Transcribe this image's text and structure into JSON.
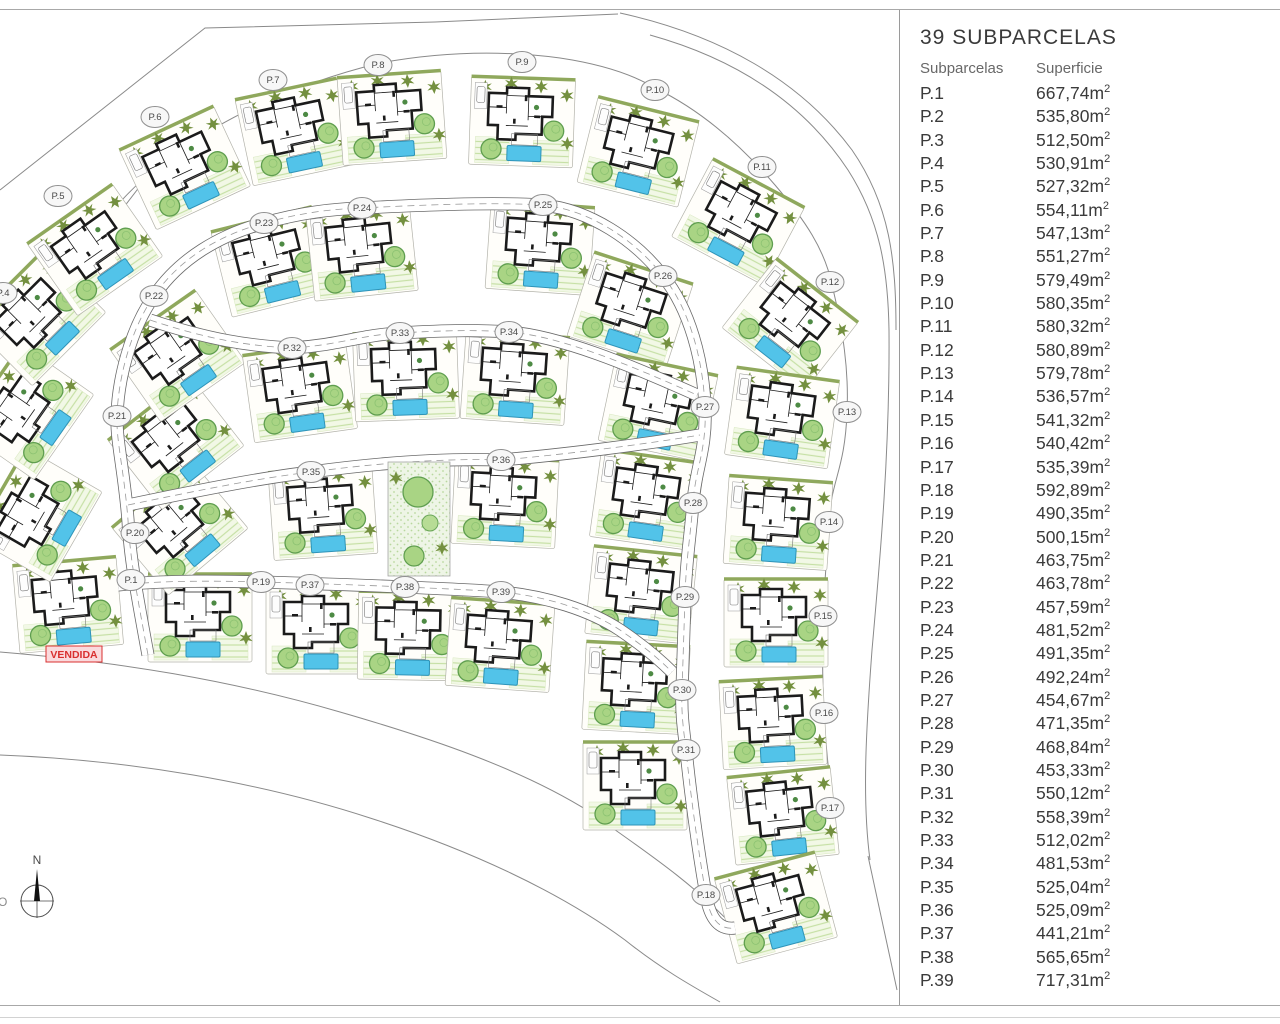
{
  "panel": {
    "title": "39 SUBPARCELAS",
    "col_subparcel": "Subparcelas",
    "col_area": "Superficie",
    "unit": "m",
    "parcels": [
      {
        "id": "P.1",
        "area": "667,74"
      },
      {
        "id": "P.2",
        "area": "535,80"
      },
      {
        "id": "P.3",
        "area": "512,50"
      },
      {
        "id": "P.4",
        "area": "530,91"
      },
      {
        "id": "P.5",
        "area": "527,32"
      },
      {
        "id": "P.6",
        "area": "554,11"
      },
      {
        "id": "P.7",
        "area": "547,13"
      },
      {
        "id": "P.8",
        "area": "551,27"
      },
      {
        "id": "P.9",
        "area": "579,49"
      },
      {
        "id": "P.10",
        "area": "580,35"
      },
      {
        "id": "P.11",
        "area": "580,32"
      },
      {
        "id": "P.12",
        "area": "580,89"
      },
      {
        "id": "P.13",
        "area": "579,78"
      },
      {
        "id": "P.14",
        "area": "536,57"
      },
      {
        "id": "P.15",
        "area": "541,32"
      },
      {
        "id": "P.16",
        "area": "540,42"
      },
      {
        "id": "P.17",
        "area": "535,39"
      },
      {
        "id": "P.18",
        "area": "592,89"
      },
      {
        "id": "P.19",
        "area": "490,35"
      },
      {
        "id": "P.20",
        "area": "500,15"
      },
      {
        "id": "P.21",
        "area": "463,75"
      },
      {
        "id": "P.22",
        "area": "463,78"
      },
      {
        "id": "P.23",
        "area": "457,59"
      },
      {
        "id": "P.24",
        "area": "481,52"
      },
      {
        "id": "P.25",
        "area": "491,35"
      },
      {
        "id": "P.26",
        "area": "492,24"
      },
      {
        "id": "P.27",
        "area": "454,67"
      },
      {
        "id": "P.28",
        "area": "471,35"
      },
      {
        "id": "P.29",
        "area": "468,84"
      },
      {
        "id": "P.30",
        "area": "453,33"
      },
      {
        "id": "P.31",
        "area": "550,12"
      },
      {
        "id": "P.32",
        "area": "558,39"
      },
      {
        "id": "P.33",
        "area": "512,02"
      },
      {
        "id": "P.34",
        "area": "481,53"
      },
      {
        "id": "P.35",
        "area": "525,04"
      },
      {
        "id": "P.36",
        "area": "525,09"
      },
      {
        "id": "P.37",
        "area": "441,21"
      },
      {
        "id": "P.38",
        "area": "565,65"
      },
      {
        "id": "P.39",
        "area": "717,31"
      }
    ]
  },
  "map": {
    "sold_label": "VENDIDA",
    "compass": {
      "north_label": "N",
      "west_label": "O"
    },
    "colors": {
      "pool": "#52c3e9",
      "pool_edge": "#2e93b8",
      "tree_fill": "#a9d484",
      "tree_edge": "#5f9e4f",
      "bush": "#74903f",
      "lawn_line": "#c6e0a5",
      "wall": "#1b1b1b",
      "road_edge": "#6a6a6a",
      "sold_red": "#d93030"
    },
    "plots": [
      {
        "label": "P.1",
        "marker": [
          131,
          580
        ],
        "house": [
          68,
          605
        ],
        "rot": -5,
        "sold": true
      },
      {
        "label": "P.2",
        "marker": null,
        "house": [
          38,
          515
        ],
        "rot": -60
      },
      {
        "label": "P.3",
        "marker": null,
        "house": [
          28,
          412
        ],
        "rot": -55
      },
      {
        "label": "P.4",
        "marker": [
          3,
          293
        ],
        "house": [
          38,
          318
        ],
        "rot": -45
      },
      {
        "label": "P.5",
        "marker": [
          58,
          196
        ],
        "house": [
          95,
          250
        ],
        "rot": -35
      },
      {
        "label": "P.6",
        "marker": [
          155,
          117
        ],
        "house": [
          185,
          168
        ],
        "rot": -25
      },
      {
        "label": "P.7",
        "marker": [
          273,
          80
        ],
        "house": [
          295,
          132
        ],
        "rot": -12
      },
      {
        "label": "P.8",
        "marker": [
          378,
          65
        ],
        "house": [
          392,
          118
        ],
        "rot": -4
      },
      {
        "label": "P.9",
        "marker": [
          522,
          62
        ],
        "house": [
          522,
          122
        ],
        "rot": 2
      },
      {
        "label": "P.10",
        "marker": [
          655,
          90
        ],
        "house": [
          638,
          152
        ],
        "rot": 14
      },
      {
        "label": "P.11",
        "marker": [
          762,
          167
        ],
        "house": [
          738,
          222
        ],
        "rot": 28
      },
      {
        "label": "P.12",
        "marker": [
          830,
          282
        ],
        "house": [
          790,
          325
        ],
        "rot": 38
      },
      {
        "label": "P.13",
        "marker": [
          847,
          412
        ],
        "house": [
          782,
          418
        ],
        "rot": 8
      },
      {
        "label": "P.14",
        "marker": [
          829,
          522
        ],
        "house": [
          778,
          523
        ],
        "rot": 4
      },
      {
        "label": "P.15",
        "marker": [
          823,
          616
        ],
        "house": [
          776,
          623
        ],
        "rot": 0
      },
      {
        "label": "P.16",
        "marker": [
          824,
          713
        ],
        "house": [
          773,
          723
        ],
        "rot": -3
      },
      {
        "label": "P.17",
        "marker": [
          830,
          808
        ],
        "house": [
          783,
          816
        ],
        "rot": -6
      },
      {
        "label": "P.18",
        "marker": [
          706,
          895
        ],
        "house": [
          776,
          908
        ],
        "rot": -15
      },
      {
        "label": "P.19",
        "marker": [
          261,
          582
        ],
        "house": [
          200,
          618
        ],
        "rot": 0
      },
      {
        "label": "P.20",
        "marker": [
          135,
          533
        ],
        "house": [
          180,
          528
        ],
        "rot": -40
      },
      {
        "label": "P.21",
        "marker": [
          117,
          416
        ],
        "house": [
          176,
          443
        ],
        "rot": -38
      },
      {
        "label": "P.22",
        "marker": [
          154,
          296
        ],
        "house": [
          178,
          356
        ],
        "rot": -35
      },
      {
        "label": "P.23",
        "marker": [
          264,
          223
        ],
        "house": [
          272,
          262
        ],
        "rot": -14
      },
      {
        "label": "P.24",
        "marker": [
          362,
          208
        ],
        "house": [
          362,
          252
        ],
        "rot": -6
      },
      {
        "label": "P.25",
        "marker": [
          543,
          205
        ],
        "house": [
          540,
          248
        ],
        "rot": 4
      },
      {
        "label": "P.26",
        "marker": [
          663,
          276
        ],
        "house": [
          630,
          310
        ],
        "rot": 18
      },
      {
        "label": "P.27",
        "marker": [
          705,
          407
        ],
        "house": [
          658,
          408
        ],
        "rot": 12
      },
      {
        "label": "P.28",
        "marker": [
          693,
          503
        ],
        "house": [
          647,
          500
        ],
        "rot": 8
      },
      {
        "label": "P.29",
        "marker": [
          685,
          597
        ],
        "house": [
          641,
          595
        ],
        "rot": 6
      },
      {
        "label": "P.30",
        "marker": [
          682,
          690
        ],
        "house": [
          636,
          688
        ],
        "rot": 3
      },
      {
        "label": "P.31",
        "marker": [
          686,
          750
        ],
        "house": [
          635,
          786
        ],
        "rot": 0
      },
      {
        "label": "P.32",
        "marker": [
          292,
          348
        ],
        "house": [
          300,
          392
        ],
        "rot": -8
      },
      {
        "label": "P.33",
        "marker": [
          400,
          333
        ],
        "house": [
          406,
          376
        ],
        "rot": -2
      },
      {
        "label": "P.34",
        "marker": [
          509,
          332
        ],
        "house": [
          515,
          378
        ],
        "rot": 4
      },
      {
        "label": "P.35",
        "marker": [
          311,
          472
        ],
        "house": [
          323,
          513
        ],
        "rot": -4
      },
      {
        "label": "P.36",
        "marker": [
          501,
          460
        ],
        "house": [
          505,
          502
        ],
        "rot": 3
      },
      {
        "label": "P.37",
        "marker": [
          310,
          585
        ],
        "house": [
          318,
          630
        ],
        "rot": 0
      },
      {
        "label": "P.38",
        "marker": [
          405,
          587
        ],
        "house": [
          410,
          636
        ],
        "rot": 1
      },
      {
        "label": "P.39",
        "marker": [
          501,
          592
        ],
        "house": [
          500,
          645
        ],
        "rot": 4
      }
    ]
  }
}
